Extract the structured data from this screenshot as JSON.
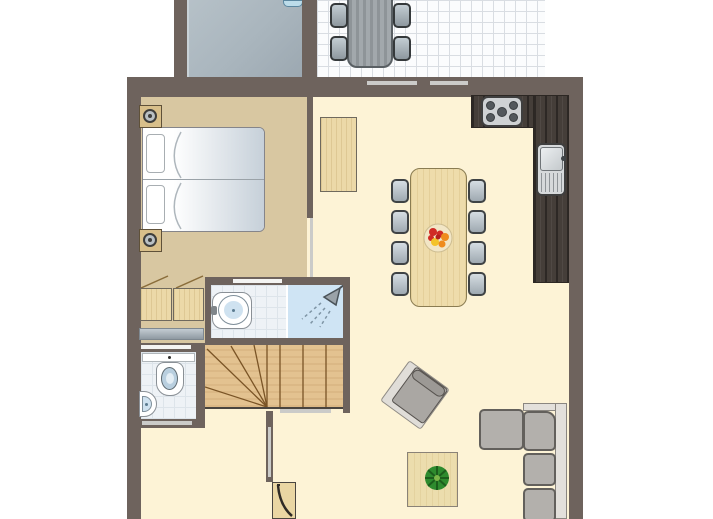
{
  "meta": {
    "kind": "holiday-home floor plan",
    "width_px": 713,
    "height_px": 519,
    "visible_text": "none"
  },
  "palette": {
    "wall": "#6e635d",
    "floor-living": "#fdf3d6",
    "floor-bedroom": "#d8c7a1",
    "floor-storage": "#a9b5bd",
    "tile-bg": "#fbfcfd",
    "tile-line": "#d9dde2",
    "bath-tile": "#eef2f6",
    "bath-tile-line": "#dde4ea",
    "shower": "#cfe4f4",
    "wood-light": "#ecd9a8",
    "wood-stairs": "#e3c290",
    "stairs-line": "#7a5426",
    "counter-dark": "#453e39",
    "chair-light": "#d5dde2",
    "chair-dark": "#9fa9b1",
    "chair-border": "#3f4345",
    "sofa": "#b3b0ac",
    "sofa-frame": "#e3e0db",
    "marker-light": "#cbcbc9",
    "marker-white": "#f4f4f2",
    "mattress": "#c6d0d9",
    "plant-green": "#2e8b2e",
    "fruit-red": "#d02b25",
    "fruit-orange": "#ef8b1d",
    "fruit-yellow": "#f4c32a"
  },
  "rooms": [
    {
      "id": "storage",
      "name": "storage room (grey floor, top left)"
    },
    {
      "id": "terrace",
      "name": "tiled terrace (top right)"
    },
    {
      "id": "bedroom",
      "name": "bedroom with double bed"
    },
    {
      "id": "closet",
      "name": "bedroom closet nook with two cabinets"
    },
    {
      "id": "bathroom",
      "name": "bathroom with washbasin and shower"
    },
    {
      "id": "wc",
      "name": "separate toilet"
    },
    {
      "id": "stairs",
      "name": "winder staircase"
    },
    {
      "id": "hall",
      "name": "entrance hall with front door"
    },
    {
      "id": "living",
      "name": "open living room"
    },
    {
      "id": "kitchen",
      "name": "L-shaped kitchen counter"
    }
  ],
  "furniture": {
    "terrace": [
      "outdoor table",
      "4 outdoor chairs"
    ],
    "bedroom": [
      "double bed (2 mattresses, 2 pillows)",
      "2 nightstands with lamps",
      "2 closet cabinets",
      "grey bench/mat"
    ],
    "bathroom": [
      "pedestal washbasin",
      "shower with showerhead"
    ],
    "wc": [
      "toilet with cistern",
      "corner handbasin"
    ],
    "kitchen": [
      "5-burner cooktop",
      "sink with drainboard"
    ],
    "living": [
      "tall cabinet",
      "dining table",
      "8 dining chairs",
      "fruit bowl",
      "armchair (rotated)",
      "coffee table with plant",
      "corner sofa"
    ],
    "hall": [
      "front door with swing"
    ]
  },
  "door_markers": {
    "terrace_sliding_door_bars": 2,
    "bedroom_door_opening": 1,
    "bathroom_door": 1,
    "wc_doors": 2,
    "hall_opening": 1
  }
}
